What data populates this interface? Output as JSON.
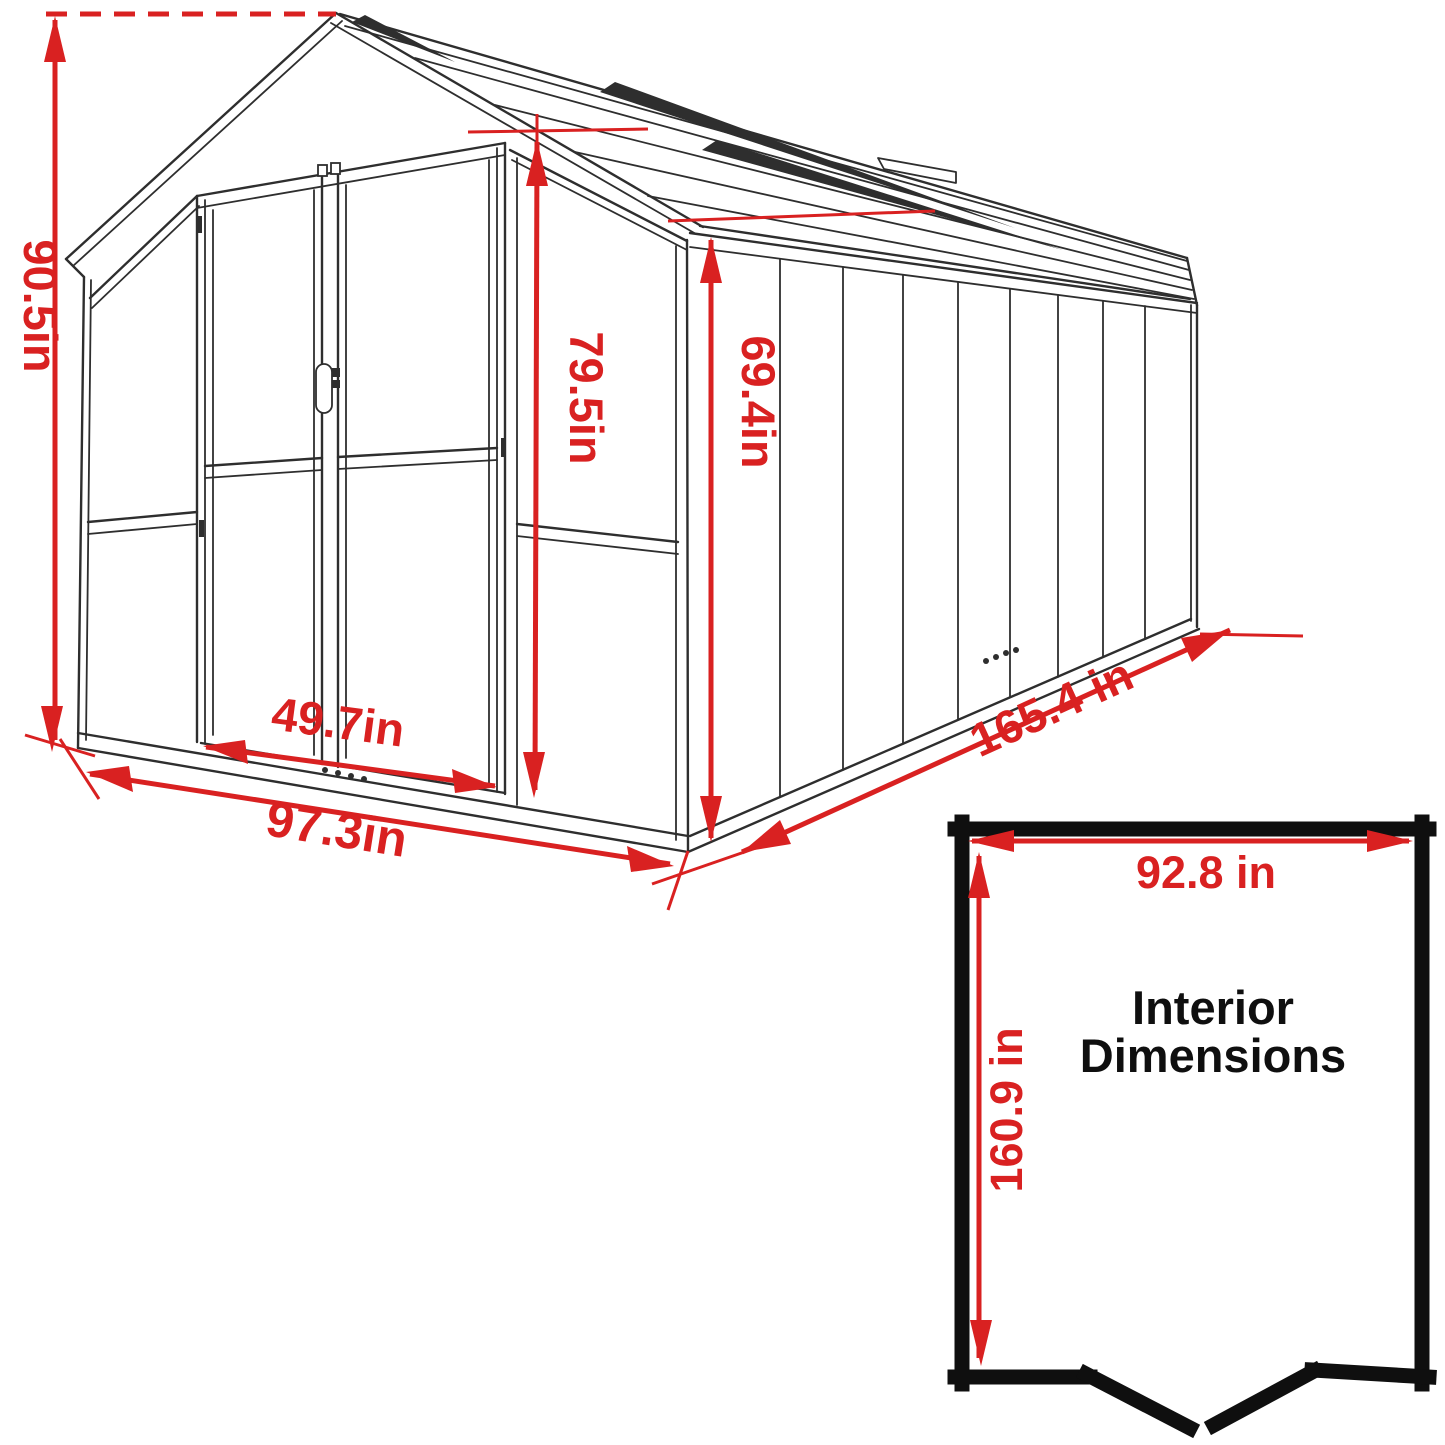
{
  "diagram": {
    "type": "greenhouse-dimension-drawing",
    "unit": "in",
    "dimensions": {
      "overall_height": "90.5in",
      "door_height": "79.5in",
      "eave_height": "69.4in",
      "door_width": "49.7in",
      "front_width": "97.3in",
      "side_length": "165.4 in"
    },
    "interior": {
      "title_line1": "Interior",
      "title_line2": "Dimensions",
      "width": "92.8 in",
      "depth": "160.9 in"
    },
    "colors": {
      "dimension": "#d92121",
      "line": "#2e2e2e",
      "inset_border": "#0f0f0f"
    }
  }
}
